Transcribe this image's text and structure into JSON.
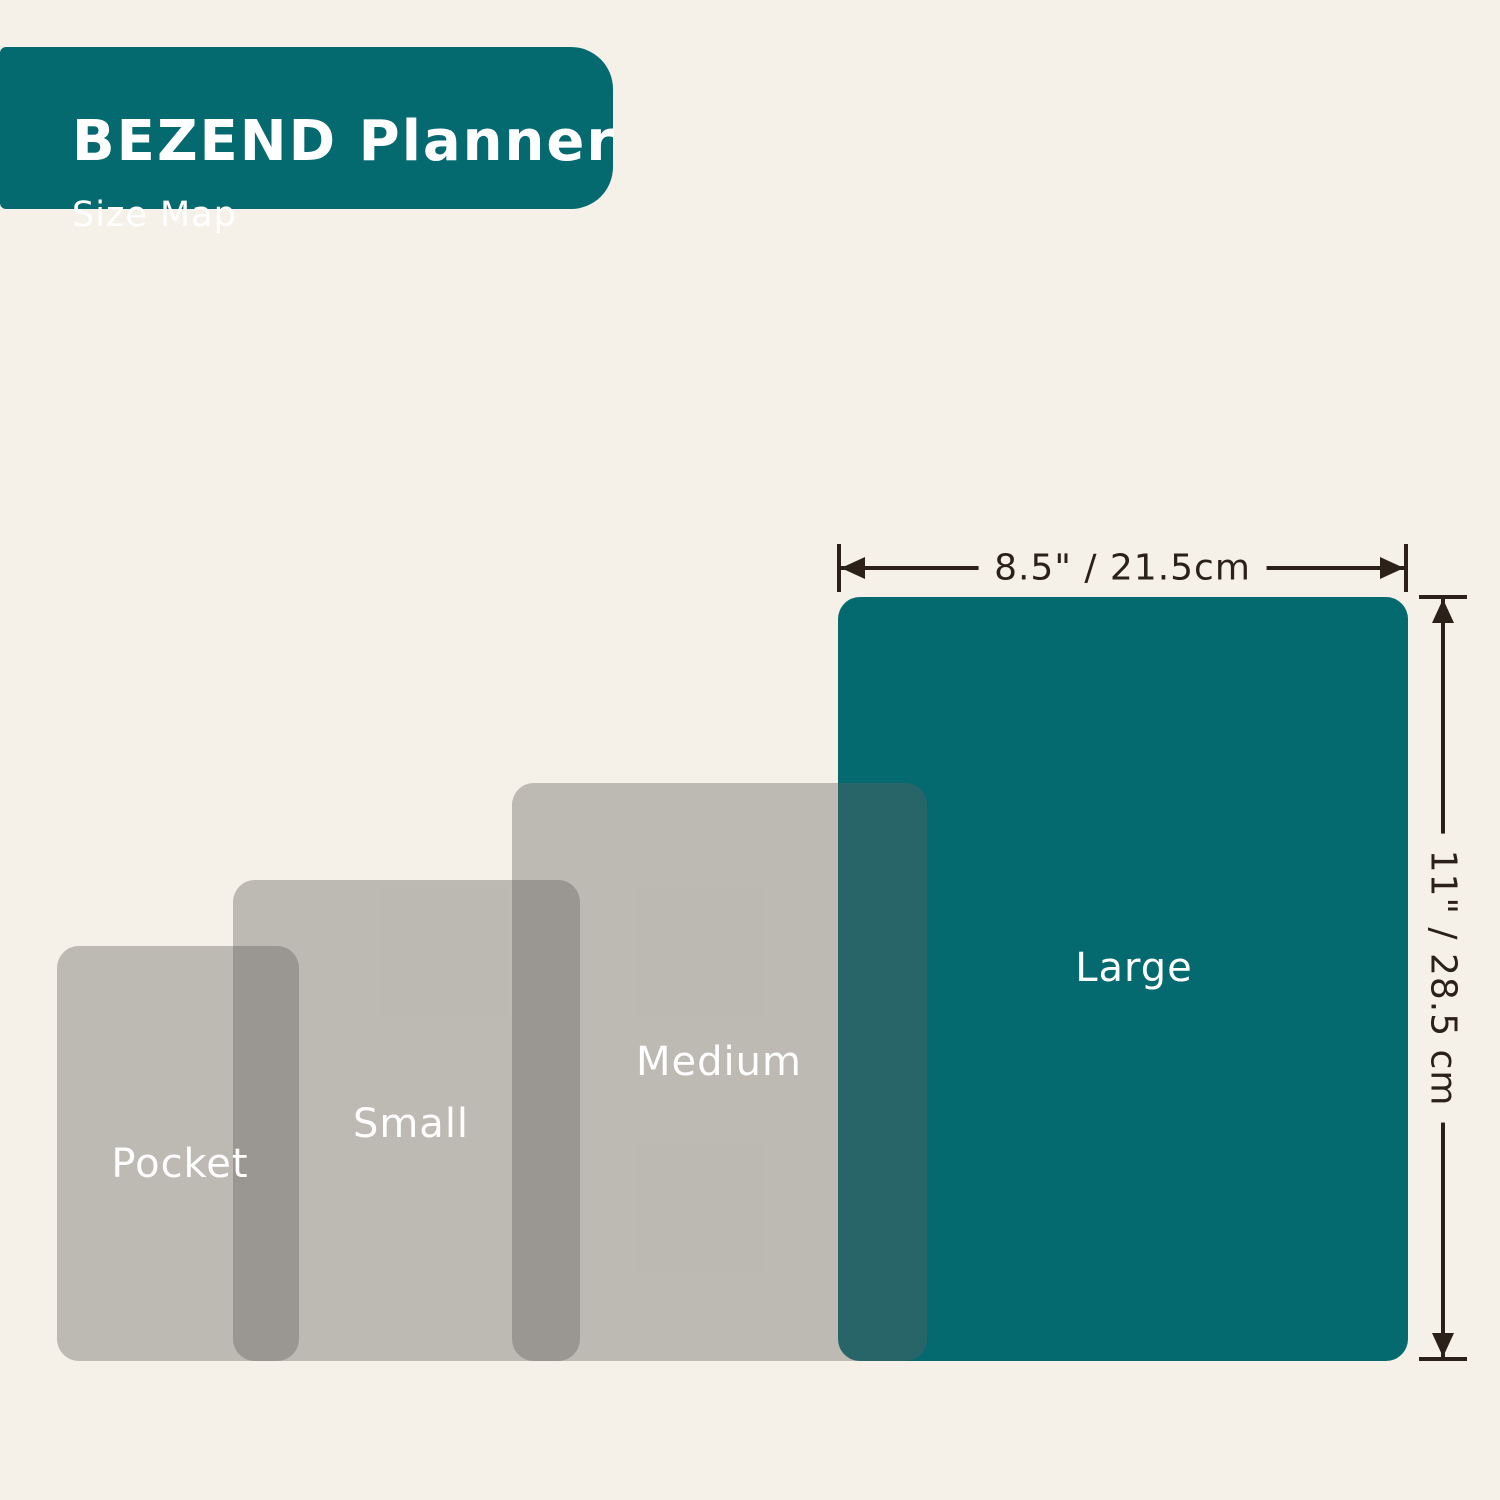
{
  "header": {
    "title": "BEZEND Planner",
    "subtitle": "Size Map"
  },
  "sizes": [
    {
      "label": "Pocket"
    },
    {
      "label": "Small"
    },
    {
      "label": "Medium"
    },
    {
      "label": "Large"
    }
  ],
  "dimensions": {
    "width_label": "8.5\" / 21.5cm",
    "height_label": "11\" / 28.5 cm"
  },
  "colors": {
    "background": "#f5f1e8",
    "teal": "#056a70",
    "gray_overlay": "rgba(96,95,93,0.38)",
    "annotation": "#2b2119",
    "label_text": "#ffffff"
  }
}
